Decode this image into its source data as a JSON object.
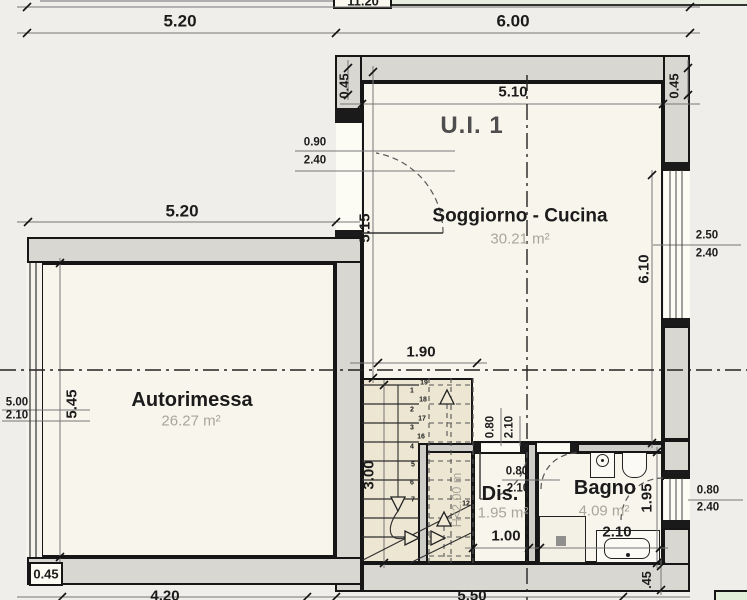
{
  "title": "U.I. 1",
  "rooms": {
    "soggiorno": {
      "name": "Soggiorno - Cucina",
      "area": "30.21 m²"
    },
    "autorimessa": {
      "name": "Autorimessa",
      "area": "26.27 m²"
    },
    "dis": {
      "name": "Dis.",
      "area": "1.95 m²"
    },
    "bagno": {
      "name": "Bagno",
      "area": "4.09 m²"
    }
  },
  "dims": {
    "overall": "11.20",
    "top_left": "5.20",
    "top_right": "6.00",
    "wall_left": "0.45",
    "interior_top": "5.10",
    "wall_right": "0.45",
    "soggiorno_height": "5.15",
    "window_height": "6.10",
    "garage_width": "5.20",
    "garage_height": "5.45",
    "stair_width": "1.90",
    "stair_run": "3.00",
    "dis_width": "1.00",
    "bagno_width": "2.10",
    "bagno_depth": "1.95",
    "wall_bottom_left": "0.45",
    "wall_bottom_right": ".45",
    "bottom_left": "4.20",
    "bottom_right": "5.50"
  },
  "openings": {
    "entry": {
      "w": "0.90",
      "h": "2.40"
    },
    "garage": {
      "w": "5.00",
      "h": "2.10"
    },
    "window": {
      "w": "2.50",
      "h": "2.40"
    },
    "dis_door": {
      "w": "0.80",
      "h": "2.10"
    },
    "bagno_door": {
      "w": "0.80",
      "h": "2.10"
    },
    "bagno_window": {
      "w": "0.80",
      "h": "2.40"
    }
  },
  "stairs": {
    "headroom": "H<2.00 m",
    "numbers": [
      "19",
      "1",
      "18",
      "2",
      "17",
      "3",
      "16",
      "4",
      "5",
      "6",
      "7",
      "12"
    ]
  }
}
